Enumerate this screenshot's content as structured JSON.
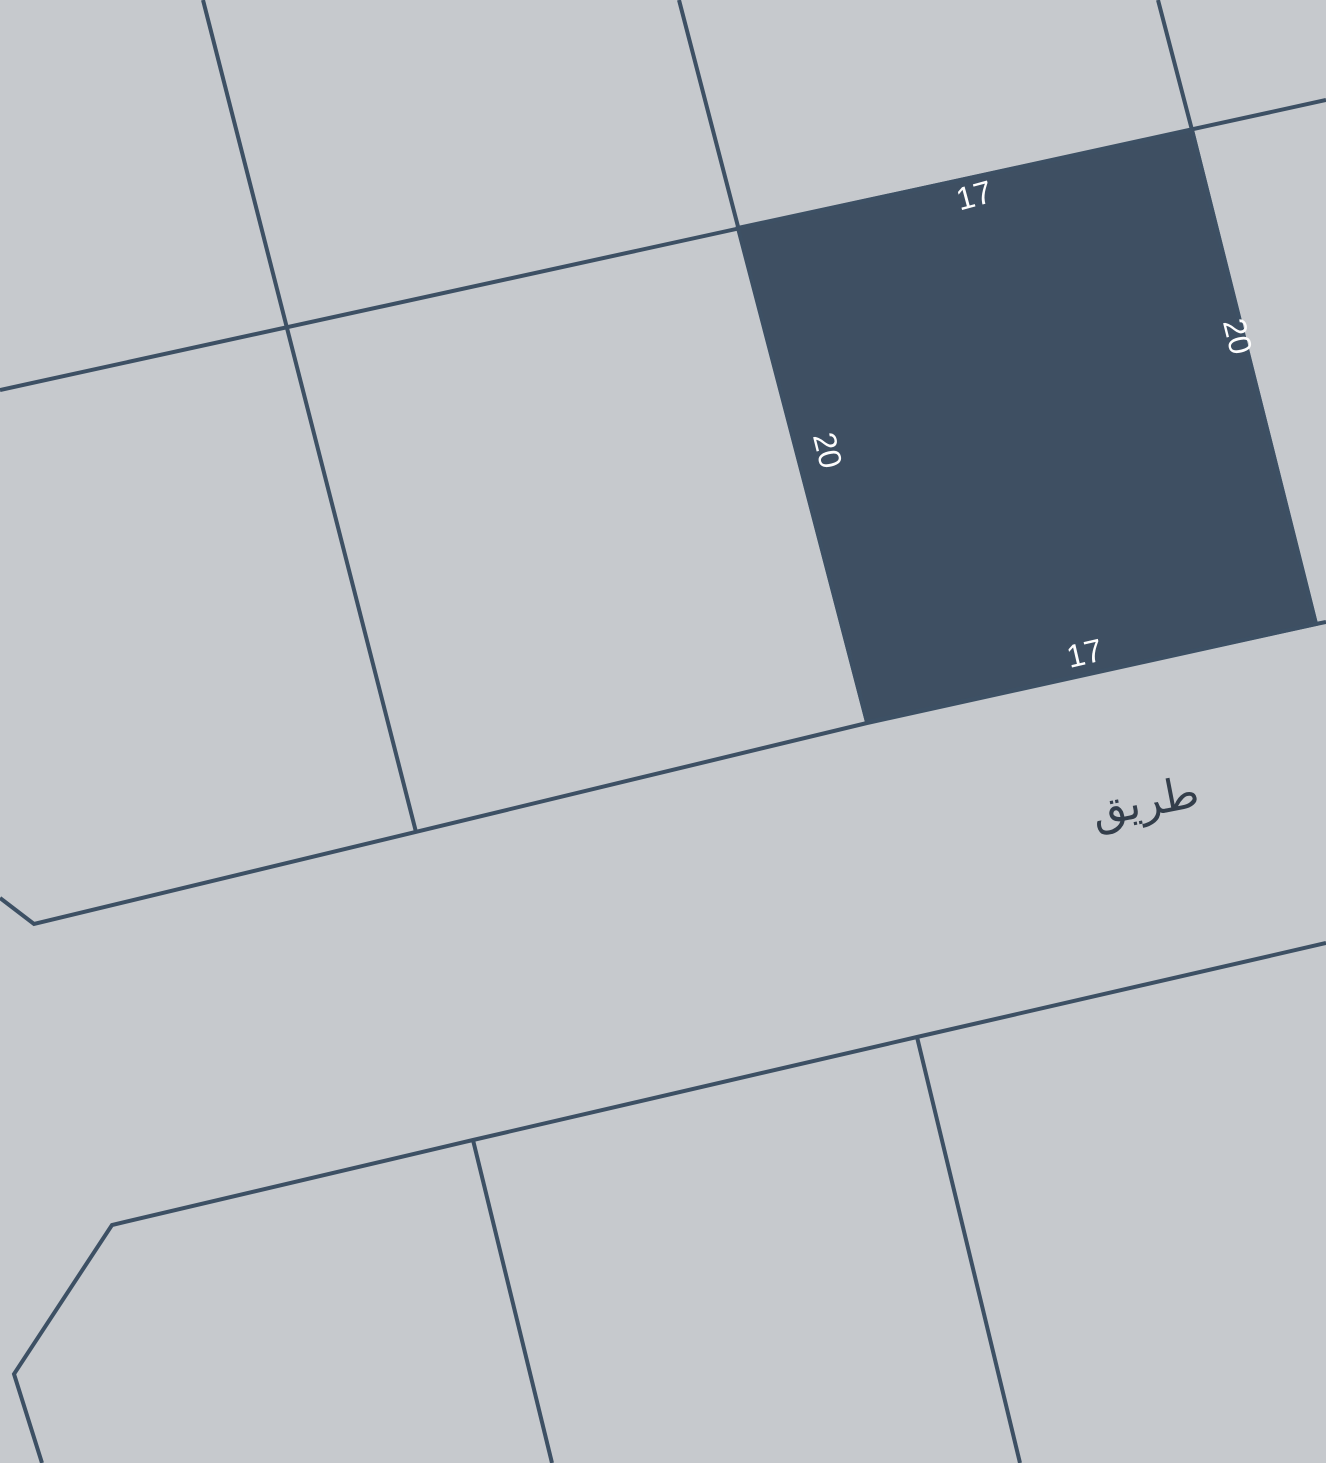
{
  "map": {
    "road_label": "طريق",
    "selected_parcel": {
      "dimension_top": "17",
      "dimension_right": "20",
      "dimension_bottom": "17",
      "dimension_left": "20"
    },
    "colors": {
      "background": "#c6c9cd",
      "boundary": "#3d5064",
      "parcel_fill": "#3e4f62",
      "dimension_text": "#fdfdfd",
      "road_text": "#333e4b"
    }
  }
}
